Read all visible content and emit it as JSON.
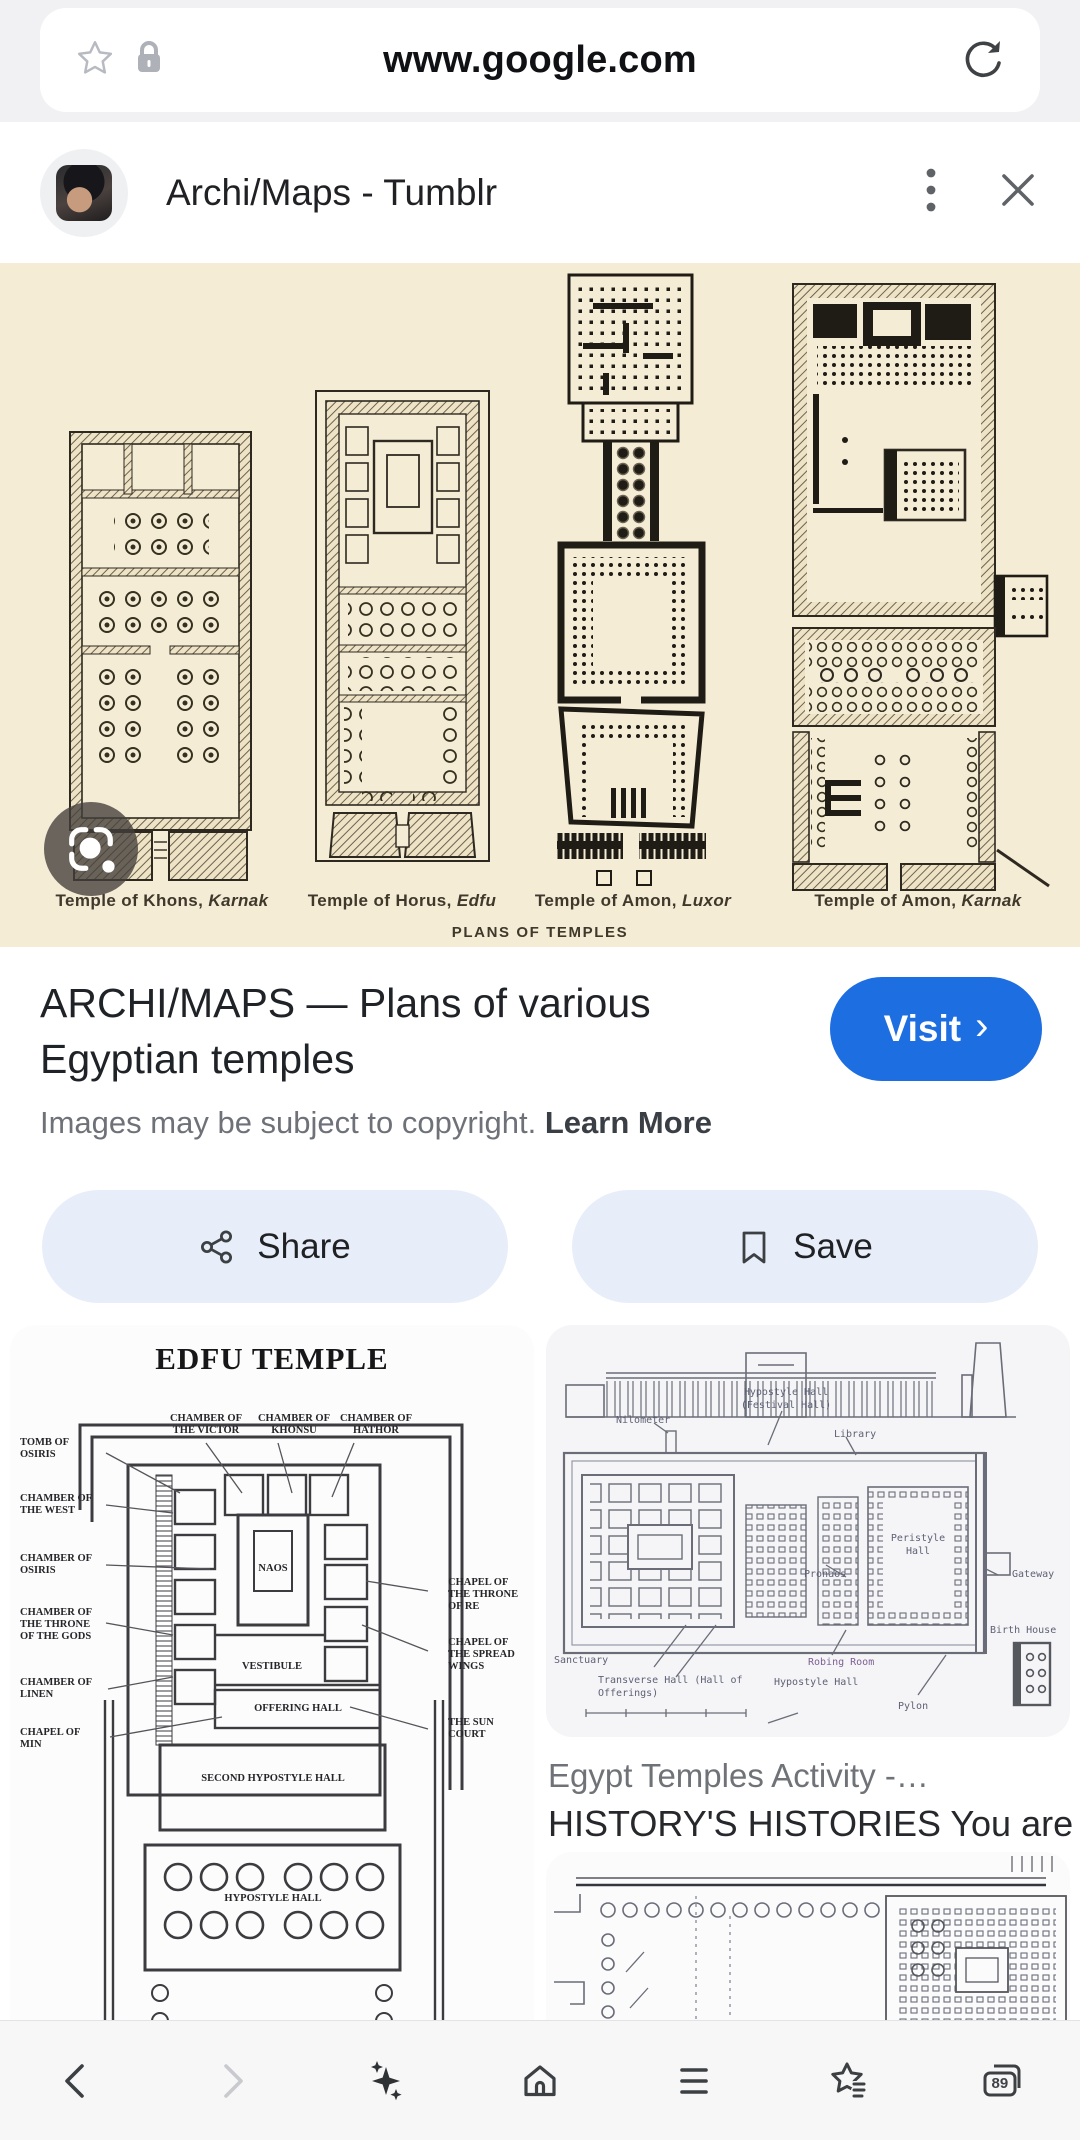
{
  "browser": {
    "url": "www.google.com"
  },
  "viewer": {
    "title": "Archi/Maps - Tumblr"
  },
  "hero": {
    "captions": [
      {
        "name": "Temple of Khons,",
        "site": "Karnak"
      },
      {
        "name": "Temple of Horus,",
        "site": "Edfu"
      },
      {
        "name": "Temple of Amon,",
        "site": "Luxor"
      },
      {
        "name": "Temple of Amon,",
        "site": "Karnak"
      }
    ],
    "footer": "PLANS OF TEMPLES"
  },
  "info": {
    "title_line1": "ARCHI/MAPS — Plans of various",
    "title_line2": "Egyptian temples",
    "visit_label": "Visit",
    "visit_chevron": "›",
    "copyright": "Images may be subject to copyright.",
    "learn_more": "Learn More"
  },
  "actions": {
    "share": "Share",
    "save": "Save"
  },
  "related": {
    "edfu": {
      "title": "EDFU TEMPLE",
      "labels": [
        "TOMB OF OSIRIS",
        "CHAMBER OF THE WEST",
        "CHAMBER OF OSIRIS",
        "CHAMBER OF THE THRONE OF THE GODS",
        "CHAMBER OF LINEN",
        "CHAPEL OF MIN",
        "CHAMBER OF THE VICTOR",
        "CHAMBER OF KHONSU",
        "CHAMBER OF HATHOR",
        "CHAPEL OF THE THRONE OF RE",
        "CHAPEL OF THE SPREAD WINGS",
        "THE SUN COURT",
        "NAOS",
        "VESTIBULE",
        "OFFERING HALL",
        "SECOND HYPOSTYLE HALL",
        "HYPOSTYLE HALL"
      ]
    },
    "egypt": {
      "labels": [
        "Nilometer",
        "Hypostyle Hall (Festival Hall)",
        "Library",
        "Peristyle Hall",
        "Pronaos",
        "Gateway",
        "Sanctuary",
        "Transverse Hall (Hall of Offerings)",
        "Robing Room",
        "Hypostyle Hall",
        "Pylon",
        "Birth House"
      ],
      "caption_title": "Egypt Temples Activity -…",
      "caption_source": "HISTORY'S HISTORIES You are…"
    }
  },
  "nav": {
    "tab_count": "89"
  },
  "colors": {
    "accent_blue": "#1d6ee0",
    "hero_background": "#f5ecd6",
    "action_pill": "#e8eef9",
    "topbar": "#f1f1f3"
  }
}
